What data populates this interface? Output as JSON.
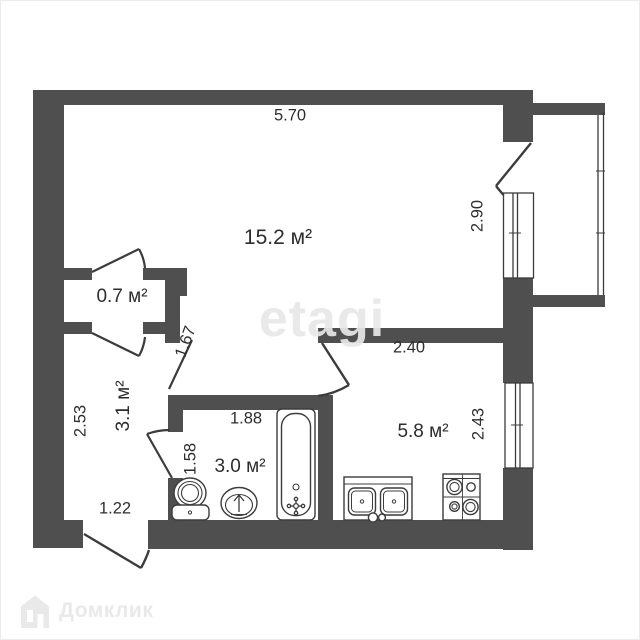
{
  "plan": {
    "areas": {
      "living": "15.2 м²",
      "closet": "0.7 м²",
      "hall": "3.1 м²",
      "bathroom": "3.0 м²",
      "kitchen": "5.8 м²"
    },
    "dims": {
      "top_width": "5.70",
      "living_balcony": "2.90",
      "kitchen_width": "2.40",
      "kitchen_window": "2.43",
      "vestibule": "1.67",
      "bathroom_width": "1.88",
      "bathroom_left": "1.58",
      "hall_height": "2.53",
      "entrance_width": "1.22"
    }
  },
  "watermark": {
    "agency": "etagi",
    "brand": "Домклик"
  },
  "fixtures": [
    "bathtub",
    "toilet-with-cistern",
    "washbasin",
    "kitchen-double-sink",
    "stove-4-burner",
    "balcony-glazing",
    "window",
    "door-swing"
  ],
  "colors": {
    "wall": "#4f4f4f",
    "fixture_line": "#3c3c3c",
    "text": "#2d2d2d",
    "watermark": "#e7e7e7",
    "brand_logo": "#e9e9e9",
    "background": "#ffffff"
  }
}
